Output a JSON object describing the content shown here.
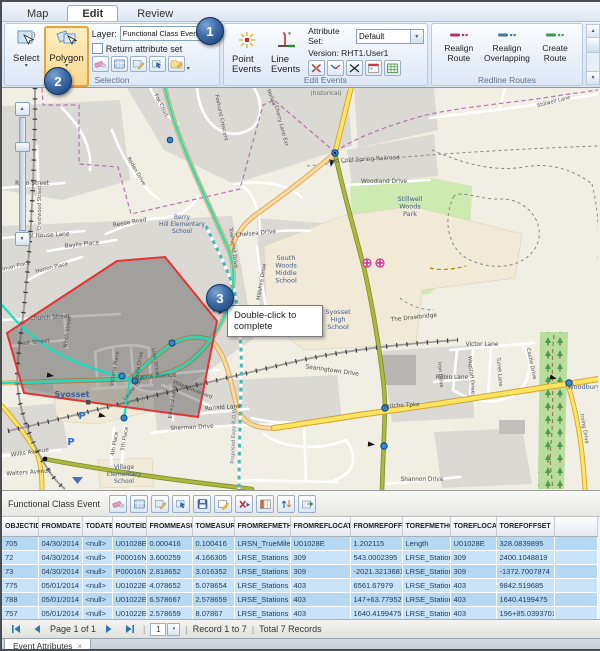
{
  "icons": {
    "dropdown": "▾",
    "close": "×",
    "separator": "|",
    "scroll_up": "▲",
    "scroll_down": "▼"
  },
  "ribbon": {
    "tabs": [
      "Map",
      "Edit",
      "Review"
    ],
    "selection": {
      "group_label": "Selection",
      "select": "Select",
      "polygon": "Polygon",
      "layer_label": "Layer:",
      "layer_value": "Functional Class Event",
      "checkbox_label": "Return attribute set"
    },
    "edit_events": {
      "group_label": "Edit Events",
      "point": "Point\nEvents",
      "line": "Line\nEvents",
      "attribute_set_label": "Attribute Set:",
      "attribute_set_value": "Default",
      "version": "Version: RHT1.User1"
    },
    "redline": {
      "group_label": "Redline Routes",
      "realign_route": "Realign\nRoute",
      "realign_overlapping": "Realign\nOverlapping",
      "create_route": "Create\nRoute"
    }
  },
  "callouts": [
    "1",
    "2",
    "3"
  ],
  "map": {
    "tooltip": "Double-click to complete",
    "labels": [
      {
        "t": "Ryan Street",
        "x": 30,
        "y": 97
      },
      {
        "t": "Crestwood Street",
        "x": 39,
        "y": 120,
        "r": -90,
        "s": 5.2
      },
      {
        "t": "School House Lane",
        "x": 40,
        "y": 149,
        "r": -3
      },
      {
        "t": "Baylis Place",
        "x": 80,
        "y": 158,
        "r": -6
      },
      {
        "t": "Fox Court",
        "x": 158,
        "y": 18,
        "r": 62,
        "s": 5.2
      },
      {
        "t": "Foxhurst Crescent",
        "x": 218,
        "y": 30,
        "r": 78,
        "s": 5.2
      },
      {
        "t": "Roden Drive",
        "x": 133,
        "y": 84,
        "r": 60,
        "s": 5.2
      },
      {
        "t": "Reese Road",
        "x": 128,
        "y": 136,
        "r": -10
      },
      {
        "t": "Berry|Hill Elementary|School",
        "x": 180,
        "y": 131,
        "s": 6,
        "c": "#455e8d"
      },
      {
        "t": "Townsend Drive",
        "x": 230,
        "y": 160,
        "r": 82,
        "s": 5.2
      },
      {
        "t": "Chelsea Drive",
        "x": 254,
        "y": 147,
        "r": -6
      },
      {
        "t": "Hollow",
        "x": 268,
        "y": 10,
        "r": 70,
        "s": 5.2
      },
      {
        "t": "Cherry Lane Ext",
        "x": 278,
        "y": 38,
        "r": 75,
        "s": 5.2
      },
      {
        "t": "(historical)",
        "x": 324,
        "y": 7,
        "c": "#6a6a6a"
      },
      {
        "t": "and Cold Spring Railroad",
        "x": 362,
        "y": 73,
        "r": -3,
        "c": "#5a5a5a"
      },
      {
        "t": "Stillwell Lane",
        "x": 552,
        "y": 15,
        "r": -14,
        "s": 5.2
      },
      {
        "t": "Woodland Drive",
        "x": 382,
        "y": 95
      },
      {
        "t": "Stillwell|Woods|Park",
        "x": 408,
        "y": 113,
        "s": 6.5,
        "c": "#455e8d"
      },
      {
        "t": "South|Woods|Middle|School",
        "x": 284,
        "y": 172,
        "s": 6.5,
        "c": "#455e8d"
      },
      {
        "t": "Syosset|High|School",
        "x": 336,
        "y": 226,
        "s": 6.5,
        "c": "#455e8d"
      },
      {
        "t": "The Drawbridge",
        "x": 412,
        "y": 231,
        "r": -6
      },
      {
        "t": "Searingtown Drive",
        "x": 330,
        "y": 284,
        "r": 8
      },
      {
        "t": "Victor Lane",
        "x": 480,
        "y": 258
      },
      {
        "t": "Robin Lane",
        "x": 450,
        "y": 291
      },
      {
        "t": "Castle Drive",
        "x": 528,
        "y": 276,
        "r": 78,
        "s": 5.2
      },
      {
        "t": "Turret Lane",
        "x": 496,
        "y": 284,
        "r": 85,
        "s": 5.2
      },
      {
        "t": "Iron Drive",
        "x": 437,
        "y": 287,
        "r": 85,
        "s": 5.2
      },
      {
        "t": "Wagstaff Drive",
        "x": 468,
        "y": 287,
        "r": 85,
        "s": 5.2
      },
      {
        "t": "Shannon Drive",
        "x": 420,
        "y": 393
      },
      {
        "t": "Woodbury",
        "x": 582,
        "y": 301,
        "s": 6.5,
        "c": "#455e8d"
      },
      {
        "t": "Jericho Tpke",
        "x": 400,
        "y": 319,
        "r": -3
      },
      {
        "t": "Syosset",
        "x": 70,
        "y": 309,
        "s": 8,
        "c": "#3a5fa0",
        "b": 1
      },
      {
        "t": "Village|Elementary|School",
        "x": 122,
        "y": 381,
        "s": 6,
        "c": "#455e8d"
      },
      {
        "t": "Willis Avenue",
        "x": 28,
        "y": 366,
        "r": -8
      },
      {
        "t": "Walters Avenue",
        "x": 27,
        "y": 386,
        "r": -4
      },
      {
        "t": "Arizona Avenue",
        "x": 152,
        "y": 290,
        "r": -4
      },
      {
        "t": "Church Street",
        "x": 48,
        "y": 231,
        "r": -3
      },
      {
        "t": "East Street",
        "x": 32,
        "y": 256,
        "r": -6
      },
      {
        "t": "Ninth Street",
        "x": 67,
        "y": 244,
        "r": -82,
        "s": 5.2
      },
      {
        "t": "Horton Place",
        "x": 50,
        "y": 181,
        "r": -14,
        "s": 5.2
      },
      {
        "t": "Elman Place",
        "x": 13,
        "y": 180,
        "r": -14,
        "s": 5.2
      },
      {
        "t": "Victoria Place",
        "x": 114,
        "y": 281,
        "r": -80,
        "s": 5.2
      },
      {
        "t": "Laurel Lane",
        "x": 133,
        "y": 301,
        "r": -50,
        "s": 5.2
      },
      {
        "t": "Lilac Drive",
        "x": 152,
        "y": 274,
        "r": 80,
        "s": 5.2
      },
      {
        "t": "Azalea Drive",
        "x": 138,
        "y": 280,
        "r": -80,
        "s": 5.2
      },
      {
        "t": "Millshire Drive",
        "x": 261,
        "y": 194,
        "r": -80,
        "s": 5.2
      },
      {
        "t": "Ronald Lane",
        "x": 221,
        "y": 321,
        "r": -4
      },
      {
        "t": "Sherman Drive",
        "x": 190,
        "y": 341,
        "r": -3
      },
      {
        "t": "Miller Boulevard",
        "x": 190,
        "y": 303,
        "r": 22,
        "s": 5.2
      },
      {
        "t": "Edward Lane",
        "x": 172,
        "y": 314,
        "r": -82,
        "s": 5.2
      },
      {
        "t": "4th Place",
        "x": 114,
        "y": 356,
        "r": -80,
        "s": 5.2
      },
      {
        "t": "5th Place",
        "x": 124,
        "y": 351,
        "r": -80,
        "s": 5.2
      },
      {
        "t": "Proposed Expy R.O.W",
        "x": 233,
        "y": 348,
        "r": -88,
        "s": 5.2,
        "c": "#5f7287"
      },
      {
        "t": "Irving Drive",
        "x": 581,
        "y": 341,
        "r": 80,
        "s": 5.2
      },
      {
        "t": "P",
        "x": 80,
        "y": 331,
        "s": 10,
        "c": "#2f6fd1",
        "b": 1
      },
      {
        "t": "P",
        "x": 69,
        "y": 357,
        "s": 10,
        "c": "#2f6fd1",
        "b": 1
      }
    ]
  },
  "panel": {
    "title": "Functional Class Event",
    "columns": [
      "OBJECTID",
      "FROMDATE",
      "TODATE",
      "ROUTEID",
      "FROMMEASURE",
      "TOMEASURE",
      "FROMREFMETHOD",
      "FROMREFLOCATION",
      "FROMREFOFFSET",
      "TOREFMETHOD",
      "TOREFLOCATION",
      "TOREFOFFSET"
    ],
    "rows": [
      [
        "705",
        "04/30/2014",
        "<null>",
        "U01028E",
        "0.000416",
        "0.100416",
        "LRSN_TrueMile",
        "U01028E",
        "1.202115",
        "Length",
        "U01028E",
        "328.0839895"
      ],
      [
        "72",
        "04/30/2014",
        "<null>",
        "P00016N",
        "3.600259",
        "4.166305",
        "LRSE_Stations",
        "309",
        "543.0002395",
        "LRSE_Stations",
        "309",
        "2400.1048819"
      ],
      [
        "73",
        "04/30/2014",
        "<null>",
        "P00016N",
        "2.818652",
        "3.016352",
        "LRSE_Stations",
        "309",
        "-2021.3213681",
        "LRSE_Stations",
        "309",
        "-1372.7007874"
      ],
      [
        "775",
        "05/01/2014",
        "<null>",
        "U01022E",
        "4.078652",
        "5.078654",
        "LRSE_Stations",
        "403",
        "6561.67979",
        "LRSE_Stations",
        "403",
        "9842.519685"
      ],
      [
        "788",
        "05/01/2014",
        "<null>",
        "U01022E",
        "6.578667",
        "2.578659",
        "LRSE_Stations",
        "403",
        "147+63.7795276",
        "LRSE_Stations",
        "403",
        "1640.4199475"
      ],
      [
        "757",
        "05/01/2014",
        "<null>",
        "U01022E",
        "2.578659",
        "8.07867",
        "LRSE_Stations",
        "403",
        "1640.4199475",
        "LRSE_Stations",
        "403",
        "196+85.0393701"
      ],
      [
        "774",
        "05/01/2014",
        "<null>",
        "U01022E",
        "9.07867",
        "4.078662",
        "LRSE_Stations",
        "403",
        "196+85.0393701",
        "LRSE_Stations",
        "403",
        "6561.67979"
      ]
    ],
    "pager": {
      "page": "Page 1 of 1",
      "page_number": "1",
      "record": "Record 1 to 7",
      "total": "Total 7 Records"
    },
    "tab_label": "Event Attributes"
  }
}
